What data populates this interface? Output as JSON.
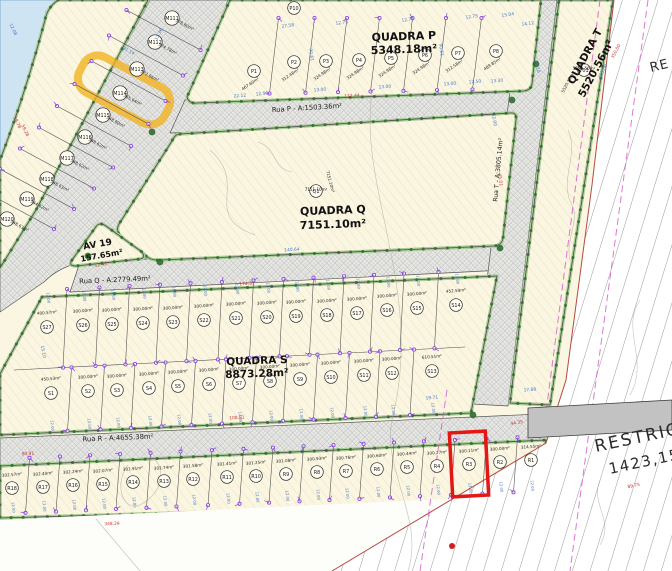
{
  "labels": {
    "quadra_p_name": "QUADRA P",
    "quadra_p_area": "5348.18m²",
    "quadra_q_name": "QUADRA Q",
    "quadra_q_area": "7151.10m²",
    "quadra_s_name": "QUADRA S",
    "quadra_s_area": "8873.28m²",
    "quadra_t_name": "QUADRA T",
    "quadra_t_area": "5520.56m²",
    "rua_p": "Rua P - A:1503.36m²",
    "rua_q": "Rua Q - A:2779.49m²",
    "rua_r": "Rua R - A:4655.38m²",
    "rua_t": "Rua T - A:3805.14m²",
    "av19_name": "AV 19",
    "av19_area": "157.65m²",
    "restricao": "RESTRIÇÃO",
    "restricao_area": "1423,15m²",
    "restricao_corner": "RE"
  },
  "highlights": {
    "selected_lot": "R3",
    "marked_lot": "M114"
  },
  "colors": {
    "lot_fill": "#fbf6e1",
    "water": "#cfe4f2",
    "selection_red": "#e51616",
    "marker_yellow": "#f2b21c",
    "dim_blue": "#4678c8",
    "dim_red": "#c23a35",
    "survey_purple": "#8a4bd6",
    "verge_green": "#a9cb96",
    "tree_green": "#2f6b2f"
  },
  "lots": {
    "m_strip": [
      {
        "id": "M111",
        "x": 172,
        "y": 18,
        "area": "378.80m²"
      },
      {
        "id": "M112",
        "x": 155,
        "y": 42,
        "area": "374.78m²"
      },
      {
        "id": "M113",
        "x": 137,
        "y": 69,
        "area": "372.66m²"
      },
      {
        "id": "M114",
        "x": 120,
        "y": 93,
        "area": "365.64m²"
      },
      {
        "id": "M115",
        "x": 103,
        "y": 115,
        "area": "348.80m²"
      },
      {
        "id": "M116",
        "x": 85,
        "y": 137,
        "area": "348.62m²"
      },
      {
        "id": "M117",
        "x": 67,
        "y": 158,
        "area": "348.62m²"
      },
      {
        "id": "M118",
        "x": 47,
        "y": 179,
        "area": "348.63m²"
      },
      {
        "id": "M119",
        "x": 27,
        "y": 199,
        "area": "344.62m²"
      },
      {
        "id": "M120",
        "x": 7,
        "y": 219,
        "area": "348.63m²"
      }
    ],
    "p_row": [
      {
        "id": "P1",
        "x": 254,
        "y": 71,
        "area": "467.60m²"
      },
      {
        "id": "P2",
        "x": 294,
        "y": 62,
        "area": "312.48m²"
      },
      {
        "id": "P3",
        "x": 326,
        "y": 61,
        "area": "324.98m²"
      },
      {
        "id": "P4",
        "x": 359,
        "y": 60,
        "area": "324.98m²"
      },
      {
        "id": "P5",
        "x": 391,
        "y": 58,
        "area": "324.98m²"
      },
      {
        "id": "P6",
        "x": 425,
        "y": 55,
        "area": "324.98m²"
      },
      {
        "id": "P7",
        "x": 458,
        "y": 53,
        "area": "312.58m²"
      },
      {
        "id": "P8",
        "x": 496,
        "y": 51,
        "area": "489.85m²"
      }
    ],
    "s_upper": [
      {
        "id": "S27",
        "x": 47,
        "y": 327,
        "area": "400.57m²"
      },
      {
        "id": "S26",
        "x": 83,
        "y": 325,
        "area": "300.00m²"
      },
      {
        "id": "S25",
        "x": 112,
        "y": 324,
        "area": "300.00m²"
      },
      {
        "id": "S24",
        "x": 143,
        "y": 323,
        "area": "300.00m²"
      },
      {
        "id": "S23",
        "x": 173,
        "y": 322,
        "area": "300.00m²"
      },
      {
        "id": "S22",
        "x": 204,
        "y": 320,
        "area": "300.00m²"
      },
      {
        "id": "S21",
        "x": 236,
        "y": 318,
        "area": "300.00m²"
      },
      {
        "id": "S20",
        "x": 267,
        "y": 317,
        "area": "300.00m²"
      },
      {
        "id": "S19",
        "x": 296,
        "y": 316,
        "area": "300.00m²"
      },
      {
        "id": "S18",
        "x": 327,
        "y": 315,
        "area": "300.00m²"
      },
      {
        "id": "S17",
        "x": 357,
        "y": 313,
        "area": "300.00m²"
      },
      {
        "id": "S16",
        "x": 387,
        "y": 310,
        "area": "300.00m²"
      },
      {
        "id": "S15",
        "x": 417,
        "y": 308,
        "area": "300.00m²"
      },
      {
        "id": "S14",
        "x": 456,
        "y": 305,
        "area": "452.59m²"
      }
    ],
    "s_lower": [
      {
        "id": "S1",
        "x": 51,
        "y": 393,
        "area": "450.53m²"
      },
      {
        "id": "S2",
        "x": 88,
        "y": 391,
        "area": "300.00m²"
      },
      {
        "id": "S3",
        "x": 117,
        "y": 390,
        "area": "300.00m²"
      },
      {
        "id": "S4",
        "x": 149,
        "y": 388,
        "area": "300.00m²"
      },
      {
        "id": "S5",
        "x": 178,
        "y": 386,
        "area": "300.00m²"
      },
      {
        "id": "S6",
        "x": 209,
        "y": 384,
        "area": "300.00m²"
      },
      {
        "id": "S7",
        "x": 239,
        "y": 383,
        "area": "300.00m²"
      },
      {
        "id": "S8",
        "x": 270,
        "y": 381,
        "area": "300.00m²"
      },
      {
        "id": "S9",
        "x": 300,
        "y": 379,
        "area": "300.00m²"
      },
      {
        "id": "S10",
        "x": 331,
        "y": 377,
        "area": "300.00m²"
      },
      {
        "id": "S11",
        "x": 364,
        "y": 375,
        "area": "300.00m²"
      },
      {
        "id": "S12",
        "x": 392,
        "y": 373,
        "area": "300.00m²"
      },
      {
        "id": "S13",
        "x": 432,
        "y": 371,
        "area": "610.51m²"
      }
    ],
    "r_row": [
      {
        "id": "R18",
        "x": 12,
        "y": 488,
        "area": "302.57m²"
      },
      {
        "id": "R17",
        "x": 43,
        "y": 487,
        "area": "302.40m²"
      },
      {
        "id": "R16",
        "x": 73,
        "y": 485,
        "area": "302.24m²"
      },
      {
        "id": "R15",
        "x": 103,
        "y": 484,
        "area": "302.07m²"
      },
      {
        "id": "R14",
        "x": 133,
        "y": 482,
        "area": "301.91m²"
      },
      {
        "id": "R13",
        "x": 164,
        "y": 481,
        "area": "301.74m²"
      },
      {
        "id": "R12",
        "x": 193,
        "y": 479,
        "area": "301.58m²"
      },
      {
        "id": "R11",
        "x": 227,
        "y": 477,
        "area": "301.41m²"
      },
      {
        "id": "R10",
        "x": 256,
        "y": 476,
        "area": "301.25m²"
      },
      {
        "id": "R9",
        "x": 286,
        "y": 474,
        "area": "301.08m²"
      },
      {
        "id": "R8",
        "x": 317,
        "y": 472,
        "area": "300.93m²"
      },
      {
        "id": "R7",
        "x": 346,
        "y": 471,
        "area": "300.76m²"
      },
      {
        "id": "R6",
        "x": 377,
        "y": 469,
        "area": "300.60m²"
      },
      {
        "id": "R5",
        "x": 407,
        "y": 467,
        "area": "300.44m²"
      },
      {
        "id": "R4",
        "x": 437,
        "y": 466,
        "area": "300.27m²"
      },
      {
        "id": "R3",
        "x": 469,
        "y": 464,
        "area": "300.11m²"
      },
      {
        "id": "R2",
        "x": 500,
        "y": 462,
        "area": "300.00m²"
      },
      {
        "id": "R1",
        "x": 531,
        "y": 460,
        "area": "314.55m²"
      }
    ],
    "extras": [
      {
        "id": "P10",
        "x": 294,
        "y": 8,
        "area": null
      },
      {
        "id": "Q1",
        "x": 316,
        "y": 191,
        "area": "7151.10m²",
        "area_x": 329,
        "area_y": 182,
        "area_rot": 75
      },
      {
        "id": "T01",
        "x": 584,
        "y": 70,
        "area": "5520.56m²",
        "area_x": 569,
        "area_y": 83,
        "area_rot": -62
      }
    ]
  },
  "dimensions": [
    {
      "t": "112.44",
      "c": "red",
      "x": 352,
      "y": 97,
      "r": -3
    },
    {
      "t": "174.31",
      "c": "red",
      "x": 247,
      "y": 285,
      "r": -3
    },
    {
      "t": "108.81",
      "c": "red",
      "x": 237,
      "y": 419,
      "r": -3
    },
    {
      "t": "90.91",
      "c": "red",
      "x": 28,
      "y": 455,
      "r": -3
    },
    {
      "t": "348.29",
      "c": "red",
      "x": 112,
      "y": 525,
      "r": -2
    },
    {
      "t": "12.45",
      "c": "red",
      "x": 101,
      "y": 266,
      "r": -9
    },
    {
      "t": "45.01",
      "c": "red",
      "x": 499,
      "y": 180,
      "r": 82
    },
    {
      "t": "350.00",
      "c": "red",
      "x": 617,
      "y": 52,
      "r": -63
    },
    {
      "t": "263.00",
      "c": "blue",
      "x": 604,
      "y": 72,
      "r": -63
    },
    {
      "t": "89.75",
      "c": "red",
      "x": 634,
      "y": 487,
      "r": -12
    },
    {
      "t": "44.35",
      "c": "red",
      "x": 517,
      "y": 424,
      "r": -10
    },
    {
      "t": "58.78",
      "c": "red",
      "x": 16,
      "y": 123,
      "r": 64
    },
    {
      "t": "59.28",
      "c": "red",
      "x": 24,
      "y": 131,
      "r": 64
    },
    {
      "t": "27.58",
      "c": "blue",
      "x": 288,
      "y": 27,
      "r": -8
    },
    {
      "t": "12.75",
      "c": "blue",
      "x": 342,
      "y": 24,
      "r": -8
    },
    {
      "t": "12.75",
      "c": "blue",
      "x": 408,
      "y": 21,
      "r": -8
    },
    {
      "t": "12.75",
      "c": "blue",
      "x": 472,
      "y": 18,
      "r": -8
    },
    {
      "t": "90.61",
      "c": "blue",
      "x": 310,
      "y": 55,
      "r": 82
    },
    {
      "t": "90.61",
      "c": "blue",
      "x": 440,
      "y": 50,
      "r": 82
    },
    {
      "t": "15.04",
      "c": "blue",
      "x": 508,
      "y": 16,
      "r": -8
    },
    {
      "t": "14.12",
      "c": "blue",
      "x": 528,
      "y": 25,
      "r": -8
    },
    {
      "t": "23.18",
      "c": "blue",
      "x": 536,
      "y": 67,
      "r": 75
    },
    {
      "t": "13.00",
      "c": "blue",
      "x": 320,
      "y": 91,
      "r": -4
    },
    {
      "t": "13.00",
      "c": "blue",
      "x": 385,
      "y": 88,
      "r": -4
    },
    {
      "t": "13.00",
      "c": "blue",
      "x": 450,
      "y": 85,
      "r": -4
    },
    {
      "t": "22.12",
      "c": "blue",
      "x": 240,
      "y": 97,
      "r": -4
    },
    {
      "t": "12.50",
      "c": "blue",
      "x": 262,
      "y": 95,
      "r": -4
    },
    {
      "t": "12.50",
      "c": "blue",
      "x": 475,
      "y": 83,
      "r": -4
    },
    {
      "t": "13.30",
      "c": "blue",
      "x": 497,
      "y": 82,
      "r": -4
    },
    {
      "t": "19.71",
      "c": "blue",
      "x": 432,
      "y": 399,
      "r": -5
    },
    {
      "t": "17.88",
      "c": "blue",
      "x": 530,
      "y": 391,
      "r": -5
    },
    {
      "t": "15.10",
      "c": "blue",
      "x": 42,
      "y": 352,
      "r": 80
    },
    {
      "t": "12.08",
      "c": "blue",
      "x": 12,
      "y": 30,
      "r": 64
    },
    {
      "t": "31.14",
      "c": "blue",
      "x": 128,
      "y": 52,
      "r": 28
    },
    {
      "t": "12.36",
      "c": "blue",
      "x": 160,
      "y": 35,
      "r": -62
    },
    {
      "t": "140.64",
      "c": "blue",
      "x": 292,
      "y": 251,
      "r": -3
    },
    {
      "t": "12.00",
      "c": "blue",
      "x": 493,
      "y": 120,
      "r": 82
    }
  ]
}
